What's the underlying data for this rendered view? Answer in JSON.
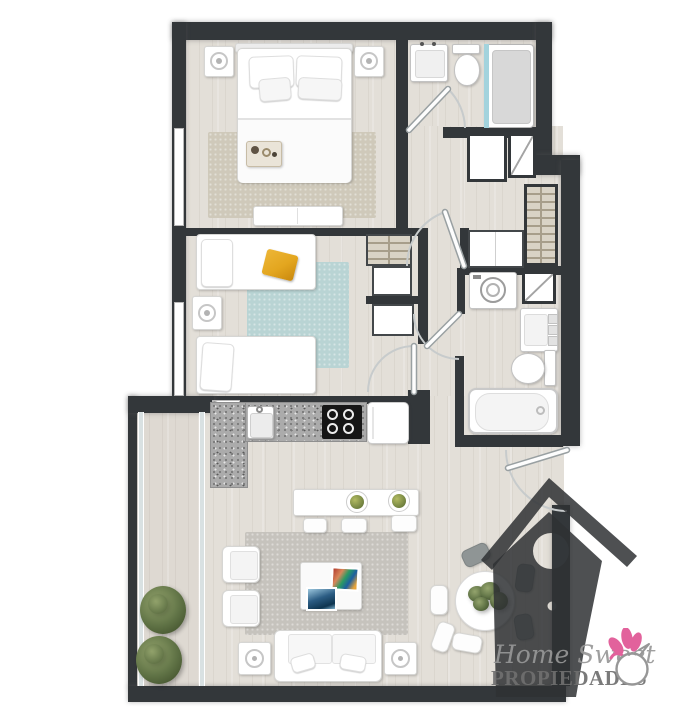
{
  "brand": {
    "script_text": "Home Sweet",
    "caps_text": "PROPIEDADES"
  },
  "palette": {
    "wall": "#33373a",
    "floor": "#e3dfd8",
    "floor_balcony": "#ded9d2",
    "rug_master": "#cfc9ba",
    "rug_kids": "#b9d4d4",
    "rug_living": "#c6c3bd",
    "granite": "#ababab",
    "cooktop": "#161616",
    "blanket_orange": "#e3a61f",
    "shower_glass": "#a3d3dd",
    "plant_green": "#5f7245",
    "logo_gray": "#979797",
    "logo_caps": "#6f6f6f",
    "bird_pink": "#e2629c",
    "watermark_fill": "rgba(47,49,52,0.85)"
  }
}
